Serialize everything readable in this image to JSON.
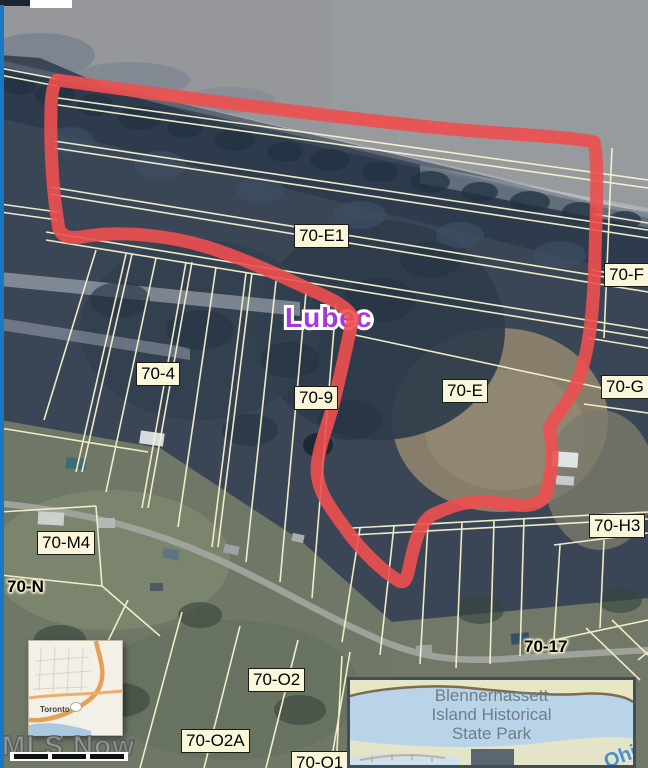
{
  "watermark": "MLS Now",
  "place_label": "Lubec",
  "parcel_labels": [
    {
      "text": "70-E1"
    },
    {
      "text": "70-F"
    },
    {
      "text": "70-4"
    },
    {
      "text": "70-9"
    },
    {
      "text": "70-E"
    },
    {
      "text": "70-G"
    },
    {
      "text": "70-M4"
    },
    {
      "text": "70-N"
    },
    {
      "text": "70-H3"
    },
    {
      "text": "70-17"
    },
    {
      "text": "70-O2"
    },
    {
      "text": "70-O2A"
    },
    {
      "text": "70-O1 3"
    }
  ],
  "inset_state_park": {
    "line1": "Blennerhassett",
    "line2": "Island Historical",
    "line3": "State Park",
    "river_label": "Ohi"
  },
  "inset_locator": {
    "town": "Toronto"
  },
  "colors": {
    "selection_outline": "#ee4f4f",
    "parcel_line": "#f7f3cd",
    "label_background": "#faf6da",
    "place_label": "#a438d8",
    "river_label": "#4a90d0",
    "left_edge_strip": "#1879c2"
  }
}
